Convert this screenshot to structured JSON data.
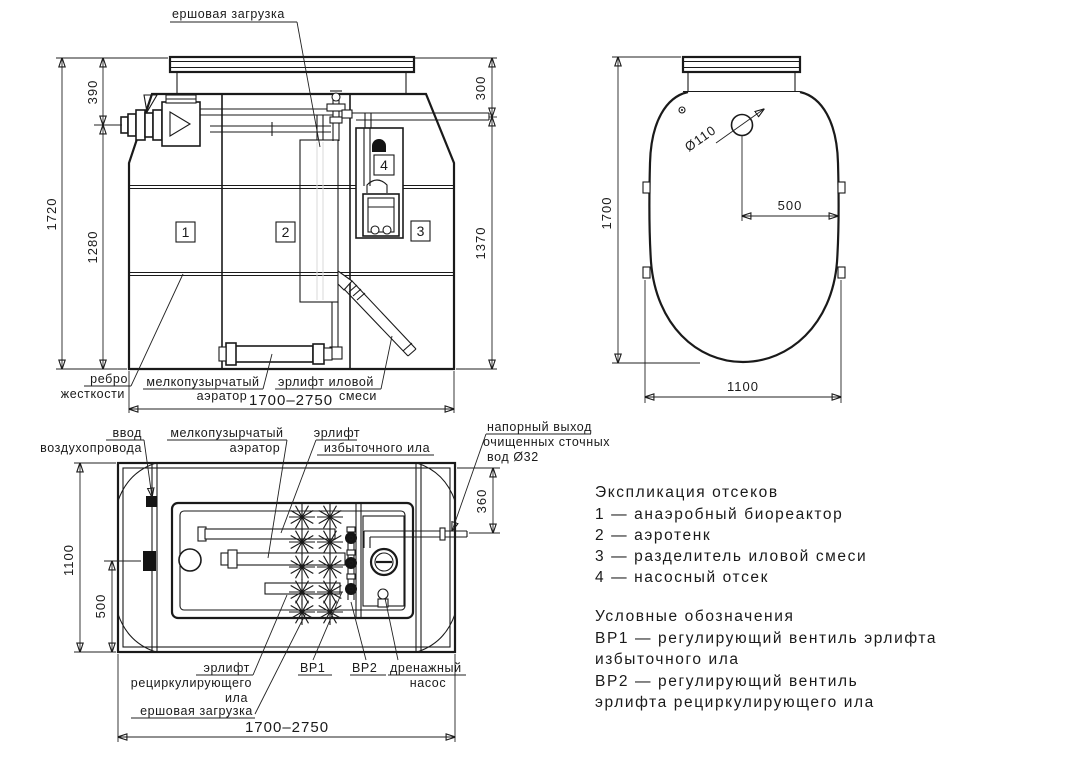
{
  "front_view": {
    "labels": {
      "brush_load": "ершовая загрузка",
      "rib_line1": "ребро",
      "rib_line2": "жесткости",
      "aerator_line1": "мелкопузырчатый",
      "aerator_line2": "аэратор",
      "airlift_line1": "эрлифт иловой",
      "airlift_line2": "смеси"
    },
    "dims": {
      "total_height": "1720",
      "top_to_inlet": "390",
      "inlet_to_bottom": "1280",
      "top_to_outlet": "300",
      "outlet_to_bottom": "1370",
      "width_range": "1700–2750"
    },
    "compartments": [
      "1",
      "2",
      "3",
      "4"
    ]
  },
  "side_view": {
    "dims": {
      "height": "1700",
      "hole_diameter": "Ø110",
      "hole_offset": "500",
      "width": "1100"
    }
  },
  "plan_view": {
    "labels": {
      "air_inlet_line1": "ввод",
      "air_inlet_line2": "воздухопровода",
      "aerator_line1": "мелкопузырчатый",
      "aerator_line2": "аэратор",
      "excess_airlift_line1": "эрлифт",
      "excess_airlift_line2": "избыточного ила",
      "outlet_line1": "напорный выход",
      "outlet_line2": "очищенных сточных",
      "outlet_line3": "вод Ø32",
      "recirc_airlift_line1": "эрлифт",
      "recirc_airlift_line2": "рециркулирующего",
      "recirc_airlift_line3": "ила",
      "brush_load": "ершовая загрузка",
      "valve1": "ВР1",
      "valve2": "ВР2",
      "drain_pump_line1": "дренажный",
      "drain_pump_line2": "насос"
    },
    "dims": {
      "width": "1100",
      "inlet_offset": "500",
      "outlet_offset": "360",
      "length_range": "1700–2750"
    }
  },
  "legend": {
    "title": "Экспликация отсеков",
    "items": [
      "1 —  анаэробный биореактор",
      "2 —  аэротенк",
      "3 —  разделитель иловой смеси",
      "4 —  насосный отсек"
    ],
    "symbols_title": "Условные обозначения",
    "symbols_lines": [
      "ВР1 —  регулирующий вентиль эрлифта",
      "избыточного ила",
      "ВР2 —  регулирующий вентиль",
      "эрлифта рециркулирующего ила"
    ]
  }
}
